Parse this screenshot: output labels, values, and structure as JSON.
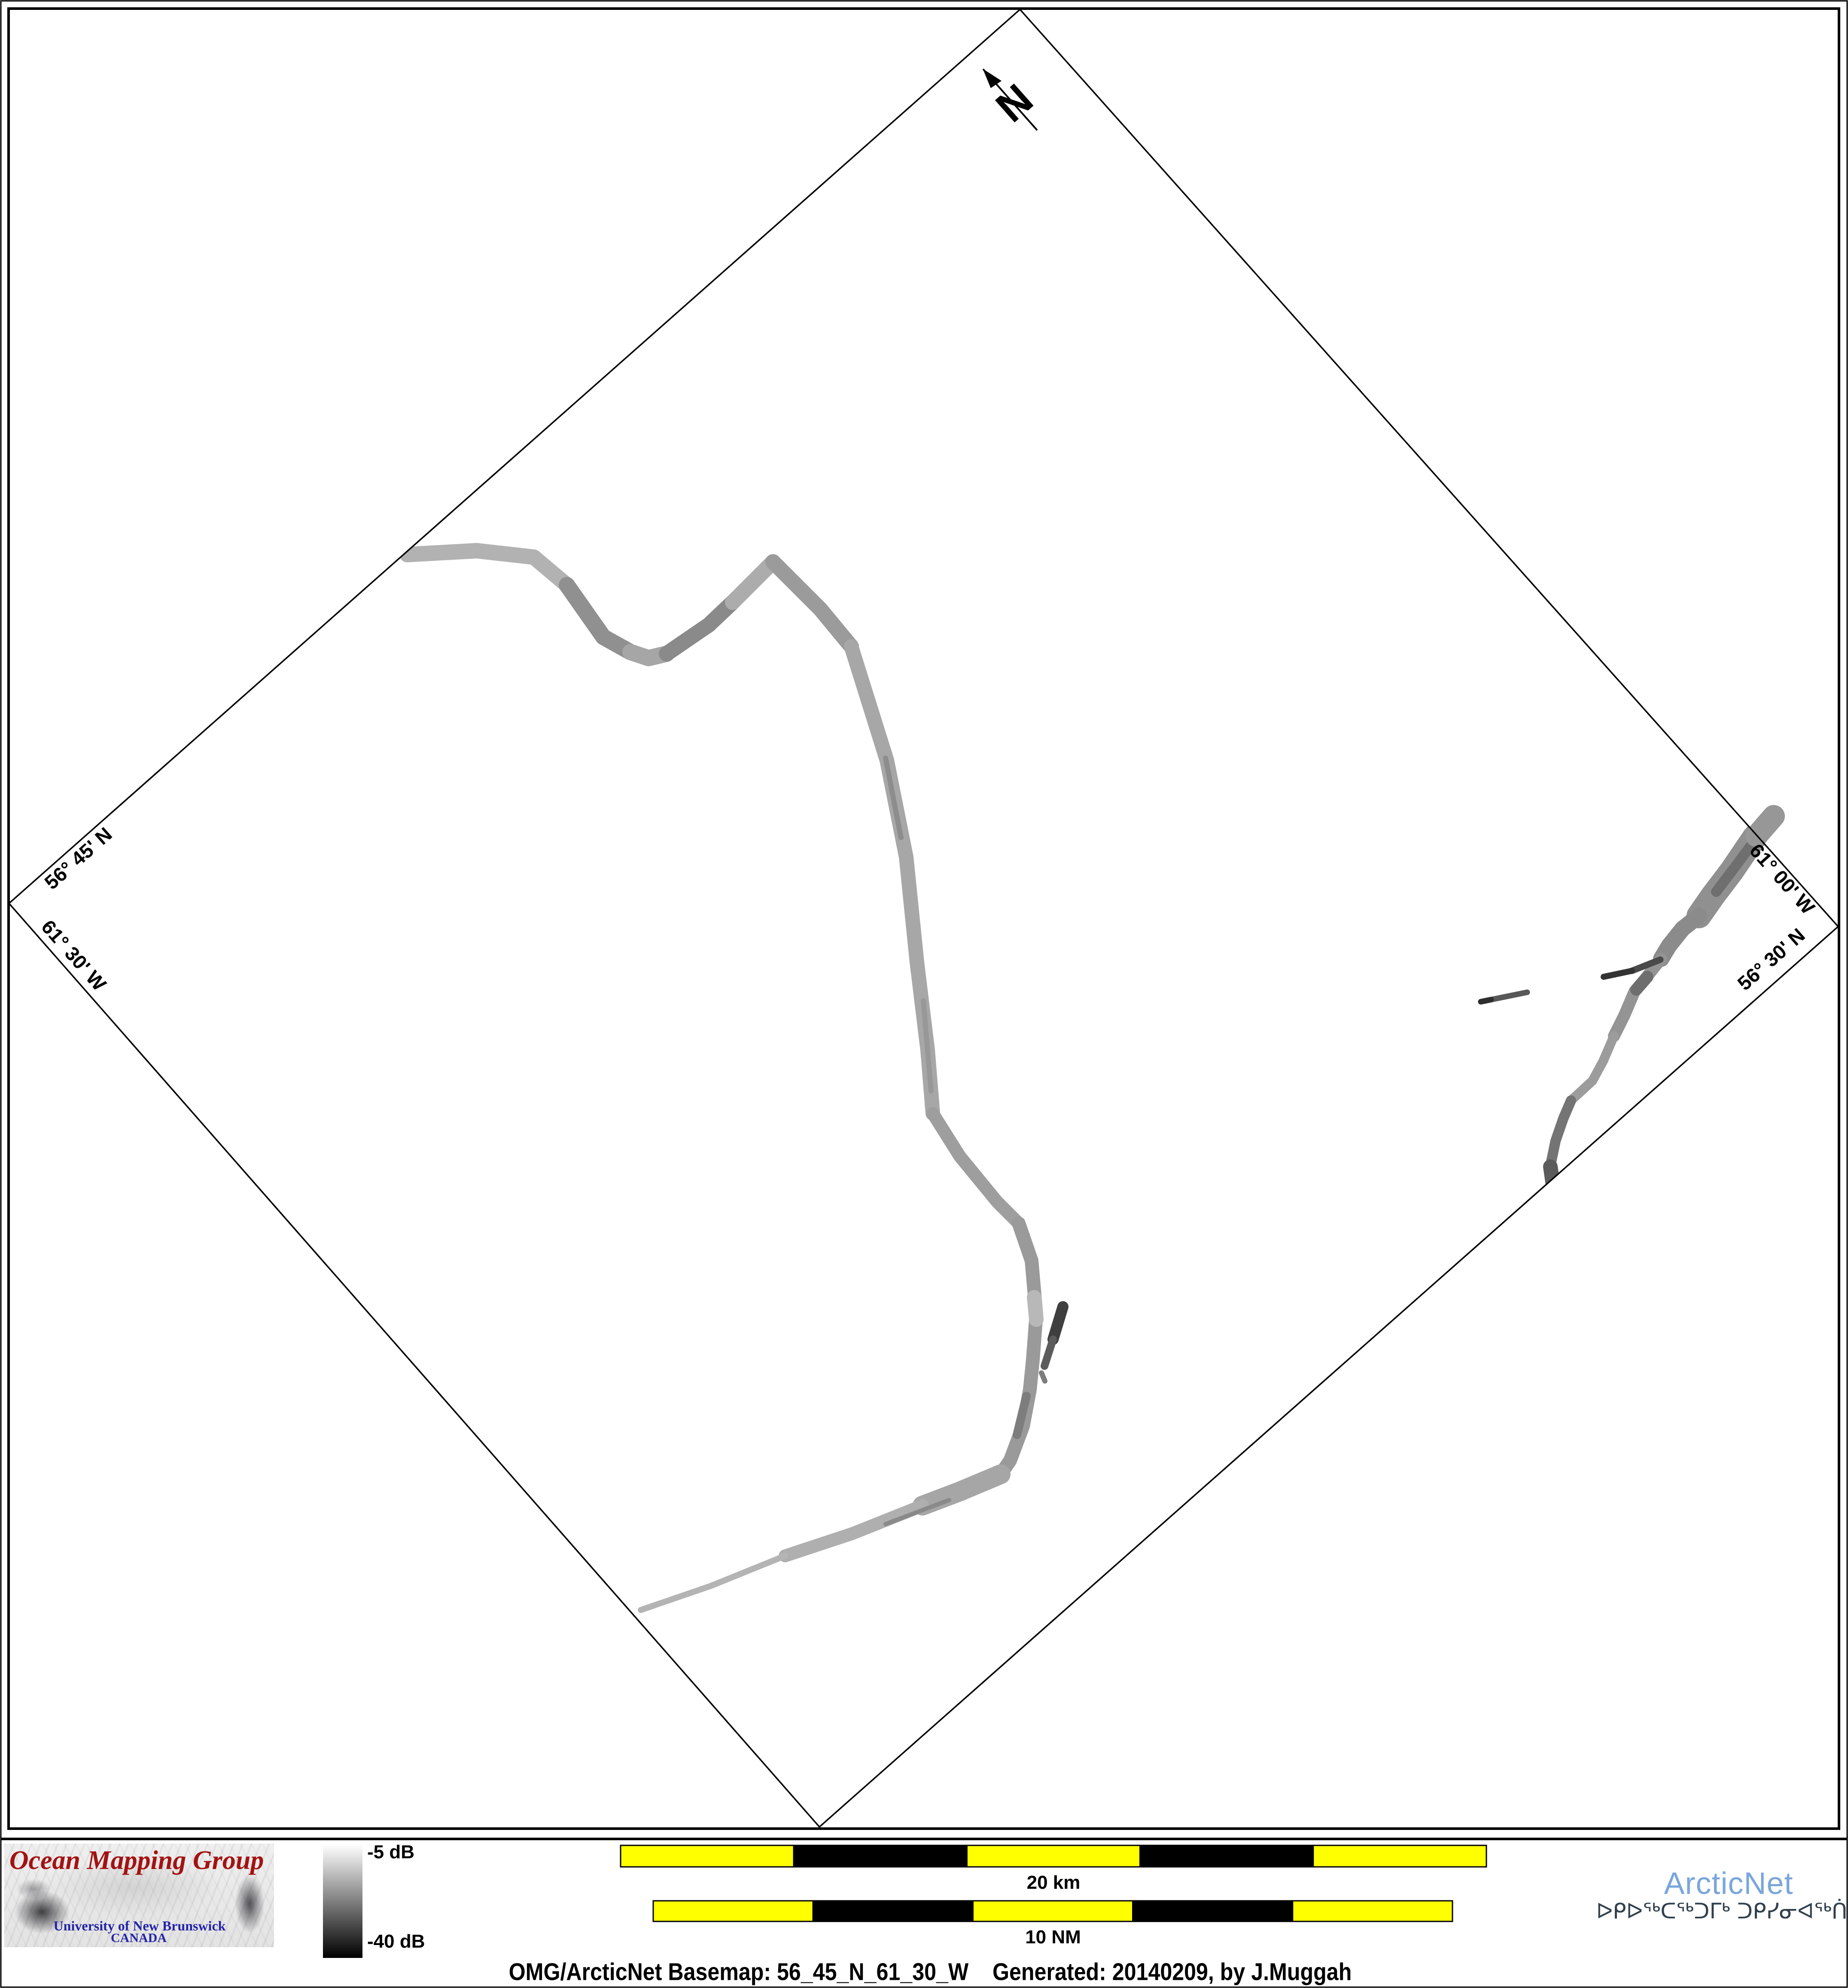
{
  "map": {
    "north_arrow_label": "N",
    "edge_labels": {
      "top_left_latitude": "56° 45' N",
      "bottom_left_longitude": "61° 30' W",
      "top_right_longitude": "61° 00' W",
      "bottom_right_latitude": "56° 30' N"
    },
    "rotation_degrees": -41.5,
    "tracks": [
      {
        "name": "west-survey-track",
        "description": "grayscale multibeam backscatter swath with M-shaped wiggle, long southward run and southwest tapering tail"
      },
      {
        "name": "east-survey-track",
        "description": "grayscale backscatter swath entering at northeast edge running southwest with short dark spur and detached strip"
      }
    ]
  },
  "colorbar": {
    "top_label": "-5 dB",
    "bottom_label": "-40 dB",
    "top_color": "#ffffff",
    "bottom_color": "#000000"
  },
  "scale_bars": {
    "kilometers": {
      "label": "20 km",
      "segments": [
        "yellow",
        "black",
        "yellow",
        "black",
        "yellow"
      ]
    },
    "nautical_miles": {
      "label": "10 NM",
      "segments": [
        "yellow",
        "black",
        "yellow",
        "black",
        "yellow"
      ]
    },
    "yellow": "#ffff00",
    "black": "#000000"
  },
  "logos": {
    "omg": {
      "title": "Ocean Mapping Group",
      "line1": "University of New Brunswick",
      "line2": "CANADA",
      "title_color": "#a31212",
      "text_color": "#2424aa"
    },
    "arcticnet": {
      "name": "ArcticNet",
      "name_color": "#7aa6db",
      "inuktitut": "ᐅᑭᐅᖅᑕᖅᑐᒥᒃ ᑐᑭᓯᓂᐊᖅᑏᑦ",
      "inuktitut_color": "#31404e"
    }
  },
  "caption": {
    "text": "OMG/ArcticNet Basemap: 56_45_N_61_30_W    Generated: 20140209, by J.Muggah"
  }
}
